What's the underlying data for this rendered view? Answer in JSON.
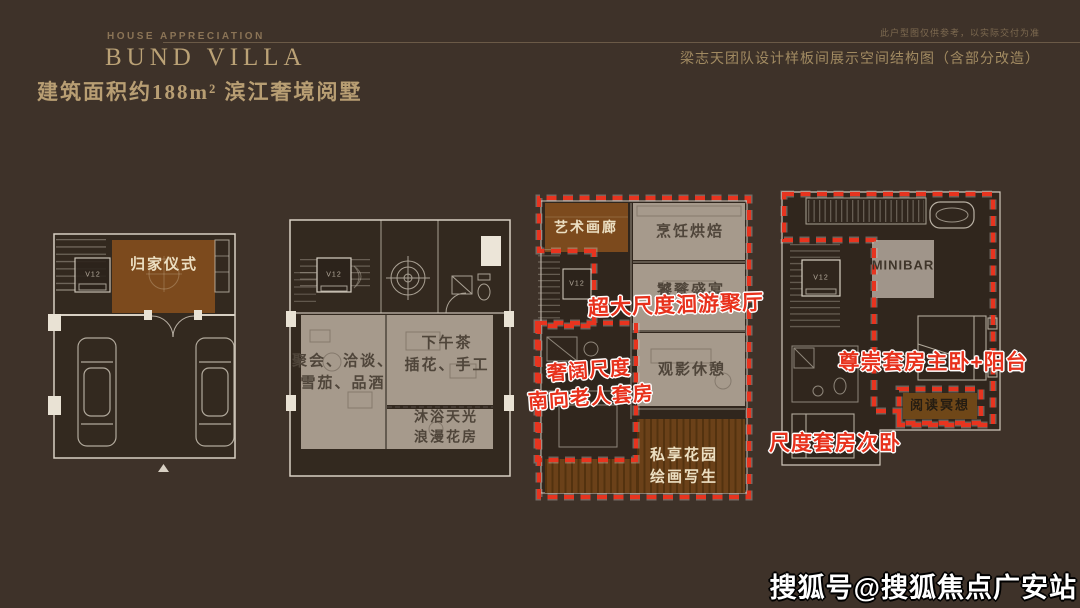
{
  "header": {
    "kicker": "HOUSE APPRECIATION",
    "brand": "BUND VILLA",
    "disclaimer": "此户型图仅供参考，以实际交付为准",
    "subtitle": "梁志天团队设计样板间展示空间结构图（含部分改造）",
    "title": "建筑面积约188m² 滨江奢境阅墅"
  },
  "plans": {
    "elevator_label": "V12",
    "basement": {
      "rooms": {
        "ritual": "归家仪式"
      }
    },
    "ground": {
      "rooms": {
        "social": [
          "聚会、洽谈、",
          "雪茄、品酒"
        ],
        "tea": [
          "下午茶",
          "插花、手工"
        ],
        "sunbath": [
          "沐浴天光",
          "浪漫花房"
        ]
      }
    },
    "first": {
      "rooms": {
        "gallery": "艺术画廊",
        "cooking": "烹饪烘焙",
        "feast": "饕餮盛宴",
        "cinema": "观影休憩",
        "garden": [
          "私享花园",
          "绘画写生"
        ]
      }
    },
    "second": {
      "rooms": {
        "minibar": "MINIBAR",
        "reading": "阅读冥想"
      }
    }
  },
  "annotations": {
    "loop_hall": "超大尺度洄游聚厅",
    "elder_suite": [
      "奢阔尺度",
      "南向老人套房"
    ],
    "master_suite": "尊崇套房主卧+阳台",
    "second_suite": "尺度套房次卧"
  },
  "watermark": "搜狐号@搜狐焦点广安站",
  "colors": {
    "background": "#3e3229",
    "gold": "#b89e73",
    "highlight_brown": "#7c4a1d",
    "highlight_gray": "#a69a8c",
    "annotation_red": "#e8311c"
  }
}
